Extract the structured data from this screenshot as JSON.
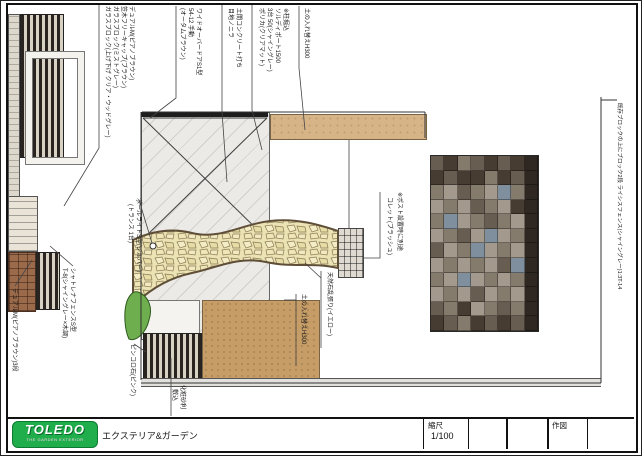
{
  "logo": {
    "name": "TOLEDO",
    "tagline": "THE GARDEN EXTERIOR",
    "subtitle": "エクステリア&ガーデン"
  },
  "title_block": {
    "scale_label": "縮尺",
    "scale_value": "1/100",
    "draw_label": "作図"
  },
  "ann": {
    "dual_fence": "デュアルM(ピアノブラウン)",
    "kasagi": "笠木フリーキャップ(ブラウン)",
    "glass1": "ガラスブロック(ミストグレー)",
    "glass2": "ガラスブロック(上げ下げ クリア・ウッドグレー)",
    "overdoor1": "ワイドオーバードアS1型",
    "overdoor2": "54-12 手動",
    "overdoor3": "(オータムブラウン)",
    "doma1": "土間コンクリート打ち",
    "doma2": "目地ノニラ",
    "port_note": "※柱掘込",
    "port1": "ソルディポート1500",
    "port2": "3台 50(シャイングレー)",
    "port3": "ポリカ(クリアマット)",
    "soil_top": "土の入れ替えH300",
    "post1": "※ポスト設置時に別途",
    "post2": "コレット(ブラッシュ)",
    "stone": "天然石乱張り(イエロー)",
    "soil_mid": "土の入れ替えH300",
    "light1": "ポールライトS型(シルバー)",
    "light2": "(トランス 1台)",
    "pinkoro": "ピンコロ石(ピンク)",
    "gravel1": "化粧砂利",
    "gravel2": "敷込",
    "fence_right": "既存ブロックの上にブロック2段 ライシスフェンス(シャイングレー)1:3T-14",
    "chatrena1": "シャトレナフェンスS型",
    "chatrena2": "T-8(シャイングレー×木調)",
    "dual_block": "デュアルM(ピアノブラウン)3段"
  },
  "colors": {
    "logo_green": "#1fae4b",
    "tagline_pink": "#ffd2ec",
    "slab": "#eceae6",
    "tan": "#d6b488",
    "soil": "#c69d66",
    "stone_fill": "#ece3b4",
    "stone_edge": "#5f4f38",
    "grass": "#6fae4e",
    "tile_a": "#a39a8d",
    "tile_b": "#857b6d",
    "tile_c": "#675d50",
    "tile_d": "#463c31",
    "tile_e": "#7f8f9d",
    "tile_k": "#2f2822"
  },
  "tiles_pattern": [
    "cdbcdcdk",
    "dcddbdck",
    "bacbaebk",
    "abacbadk",
    "beabcbak",
    "abcaeabk",
    "cabeabak",
    "ababacek",
    "baeababk",
    "abacabak",
    "cbdabcbk",
    "dcbdcdck"
  ]
}
